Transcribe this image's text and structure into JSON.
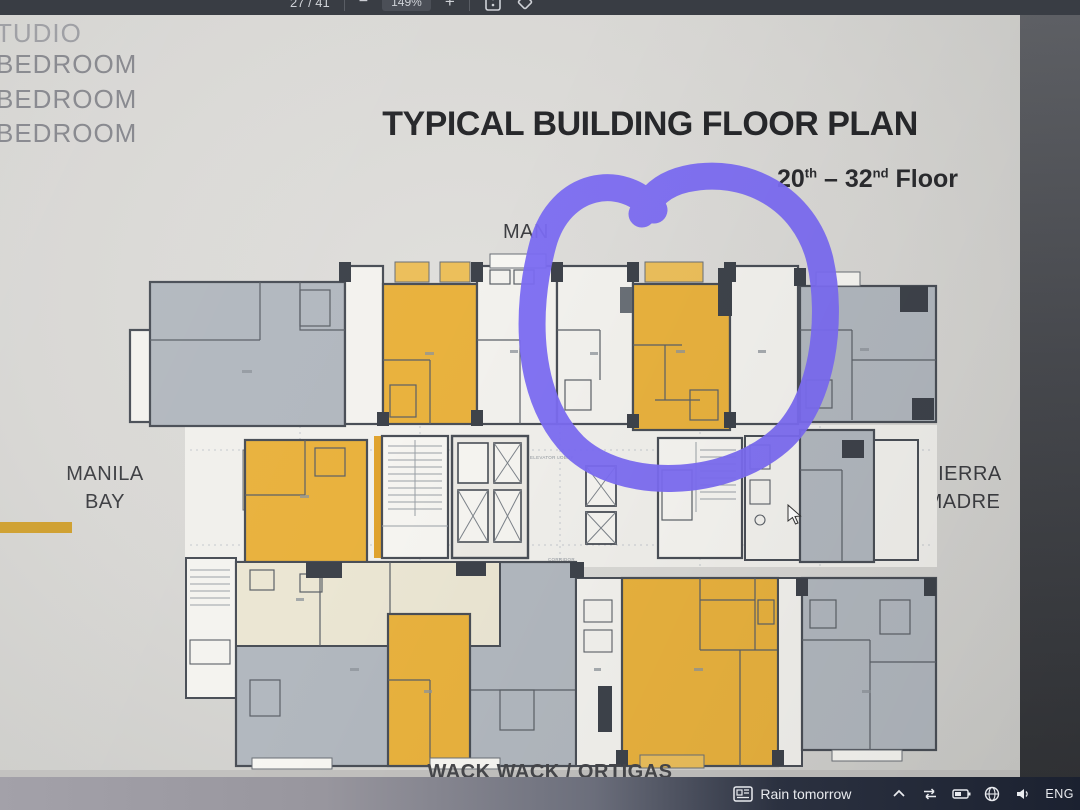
{
  "viewer_toolbar": {
    "page_indicator": "27 / 41",
    "zoom_out_label": "−",
    "zoom_level": "149%",
    "zoom_in_label": "+"
  },
  "legend_fragments": {
    "line1": "TUDIO",
    "line2": "BEDROOM",
    "line3": "BEDROOM",
    "line4": "BEDROOM"
  },
  "slide": {
    "title": "TYPICAL BUILDING FLOOR PLAN",
    "floor_range": {
      "start_num": "20",
      "start_sup": "th",
      "separator": " – ",
      "end_num": "32",
      "end_sup": "nd",
      "word": " Floor"
    },
    "orientation": {
      "top_partial": "MAN",
      "west_line1": "MANILA",
      "west_line2": "BAY",
      "east_line1": "SIERRA",
      "east_line2": "MADRE",
      "south": "WACK WACK / ORTIGAS"
    },
    "plan_labels": {
      "elevator_lobby": "ELEVATOR LOBBY",
      "corridor": "CORRIDOR"
    },
    "colors": {
      "unit_orange": "#e9b23e",
      "unit_gray": "#b2b8bf",
      "unit_cream": "#ebe6d3",
      "unit_white": "#f3f2ee",
      "wall": "#4a4f57",
      "annotation_purple": "#7b6cf2",
      "accent_gold_bar": "#cf9f2e"
    }
  },
  "taskbar": {
    "weather_text": "Rain tomorrow",
    "language_label": "ENG"
  }
}
